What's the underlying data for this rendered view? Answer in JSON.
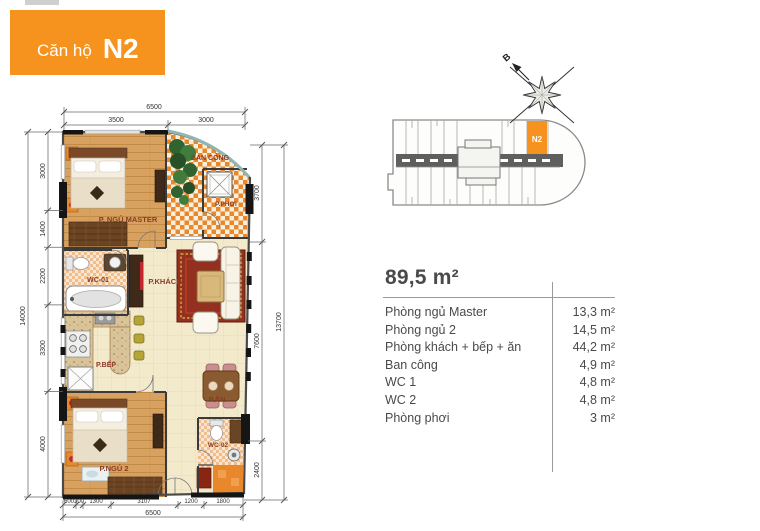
{
  "banner": {
    "prefix": "Căn hộ",
    "unit": "N2"
  },
  "site_plan": {
    "unit_label": "N2",
    "compass_label": "B"
  },
  "floor_plan": {
    "rooms": {
      "master": "P. NGỦ MASTER",
      "balcony": "BAN CÔNG",
      "drying": "P.PHƠI",
      "wc1": "WC-01",
      "living": "P.KHÁCH",
      "kitchen": "P.BẾP",
      "dining": "P.ĂN",
      "bedroom2": "P.NGỦ 2",
      "wc2": "WC-02"
    },
    "dimensions": {
      "top_total": "6500",
      "top_segments": [
        "3500",
        "3000"
      ],
      "left_total": "14000",
      "left_segments": [
        "3000",
        "1400",
        "2200",
        "3300",
        "4000"
      ],
      "right_total": "13700",
      "right_segments": [
        "3700",
        "7600",
        "2400"
      ],
      "bottom_total": "6500",
      "bottom_segments": [
        "600",
        "300",
        "1300",
        "3107",
        "1200",
        "1800"
      ]
    }
  },
  "area_table": {
    "total": "89,5 m²",
    "rows": [
      {
        "label": "Phòng ngủ Master",
        "value": "13,3 m²"
      },
      {
        "label": "Phòng ngủ 2",
        "value": "14,5 m²"
      },
      {
        "label": "Phòng khách + bếp + ăn",
        "value": "44,2 m²"
      },
      {
        "label": "Ban công",
        "value": "4,9 m²"
      },
      {
        "label": "WC 1",
        "value": "4,8 m²"
      },
      {
        "label": "WC 2",
        "value": "4,8 m²"
      },
      {
        "label": "Phòng phơi",
        "value": "3 m²"
      }
    ]
  },
  "colors": {
    "accent_orange": "#F6921E",
    "checker_orange": "#E8872B",
    "room_label_red": "#8C3B25",
    "wood_floor": "#D8A160",
    "tile_cream": "#F3E9CB",
    "table_text": "#4A4A4A"
  }
}
